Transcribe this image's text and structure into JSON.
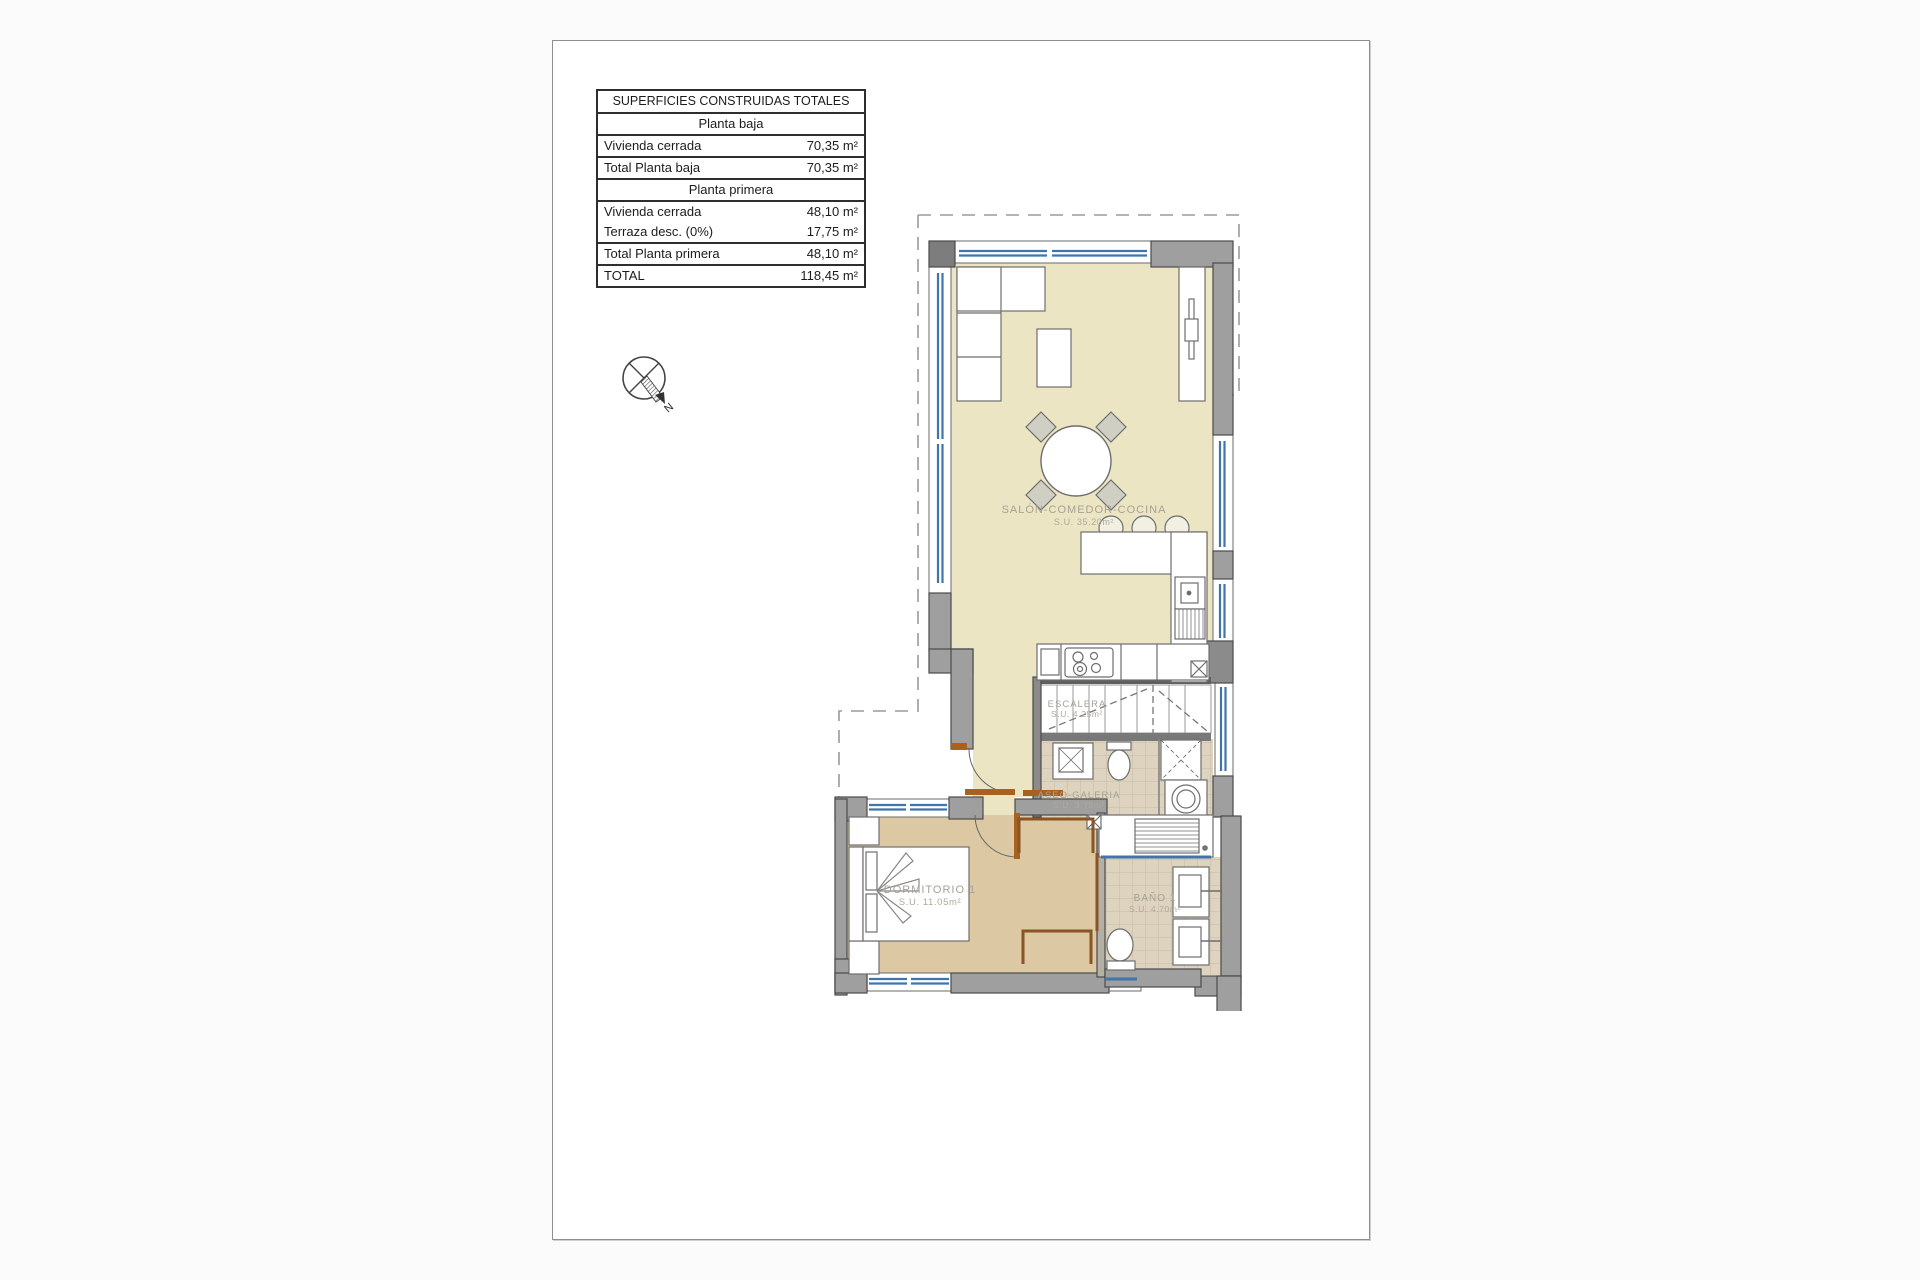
{
  "table": {
    "rows": [
      {
        "type": "title",
        "label": "SUPERFICIES CONSTRUIDAS TOTALES",
        "value": ""
      },
      {
        "type": "section",
        "label": "Planta baja",
        "value": ""
      },
      {
        "type": "row",
        "label": "Vivienda cerrada",
        "value": "70,35 m²"
      },
      {
        "type": "row",
        "label": "Total Planta baja",
        "value": "70,35 m²"
      },
      {
        "type": "section",
        "label": "Planta primera",
        "value": ""
      },
      {
        "type": "row",
        "label": "Vivienda cerrada",
        "value": "48,10 m²"
      },
      {
        "type": "row",
        "label": "Terraza desc. (0%)",
        "value": "17,75 m²"
      },
      {
        "type": "row",
        "label": "Total Planta primera",
        "value": "48,10 m²"
      },
      {
        "type": "row",
        "label": "TOTAL",
        "value": "118,45 m²"
      }
    ]
  },
  "compass": {
    "north_label": "N"
  },
  "plan": {
    "rooms": {
      "salon": {
        "name": "SALÓN-COMEDOR-COCINA",
        "area": "S.U. 35.20m²"
      },
      "escalera": {
        "name": "ESCALERA",
        "area": "S.U. 4.25m²"
      },
      "aseo_galeria": {
        "name": "ASEO-GALERIA",
        "area": "S.U. 3.75m²"
      },
      "dormitorio": {
        "name": "DORMITORIO 1",
        "area": "S.U. 11.05m²"
      },
      "bano": {
        "name": "BAÑO 1",
        "area": "S.U. 4.70m²"
      }
    },
    "colors": {
      "salon_floor": "#ebe5c4",
      "dormitorio_floor": "#dcc9a4",
      "tile_floor": "#ddd3bf",
      "wall": "#9f9f9f",
      "window": "#3f74ad",
      "door": "#a8611f",
      "label": "#a6a296"
    }
  }
}
